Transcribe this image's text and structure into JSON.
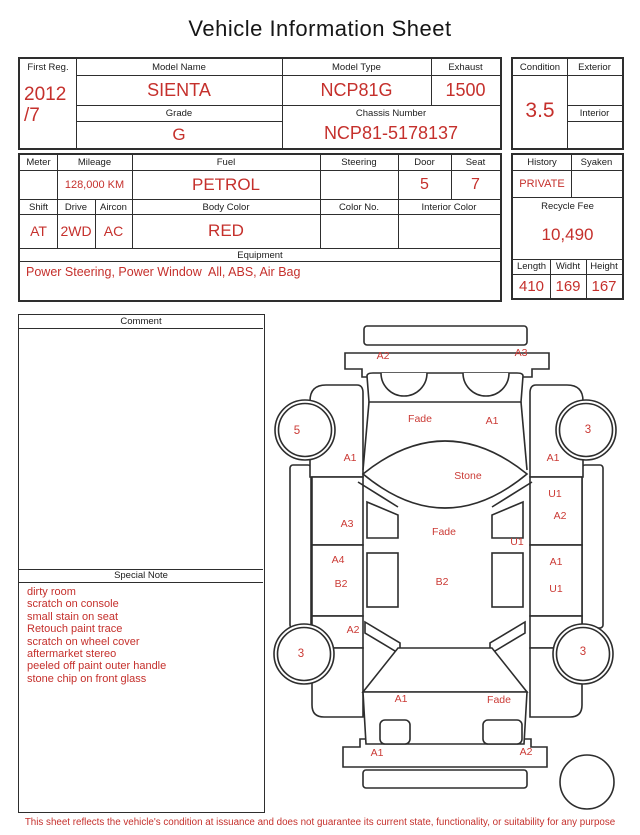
{
  "title": "Vehicle Information Sheet",
  "accent_color": "#c5302c",
  "table1": {
    "first_reg_label": "First Reg.",
    "first_reg_line1": "2012",
    "first_reg_line2": "/7",
    "model_name_label": "Model Name",
    "model_name": "SIENTA",
    "model_type_label": "Model Type",
    "model_type": "NCP81G",
    "exhaust_label": "Exhaust",
    "exhaust": "1500",
    "grade_label": "Grade",
    "grade": "G",
    "chassis_label": "Chassis Number",
    "chassis": "NCP81-5178137",
    "condition_label": "Condition",
    "condition": "3.5",
    "exterior_label": "Exterior",
    "exterior": "",
    "interior_label": "Interior",
    "interior": ""
  },
  "table2": {
    "meter_label": "Meter",
    "meter": "",
    "mileage_label": "Mileage",
    "mileage": "128,000 KM",
    "fuel_label": "Fuel",
    "fuel": "PETROL",
    "steering_label": "Steering",
    "steering": "",
    "door_label": "Door",
    "door": "5",
    "seat_label": "Seat",
    "seat": "7",
    "shift_label": "Shift",
    "shift": "AT",
    "drive_label": "Drive",
    "drive": "2WD",
    "aircon_label": "Aircon",
    "aircon": "AC",
    "body_color_label": "Body Color",
    "body_color": "RED",
    "color_no_label": "Color No.",
    "color_no": "",
    "interior_color_label": "Interior Color",
    "interior_color": "",
    "equipment_label": "Equipment",
    "equipment": "Power Steering, Power Window  All, ABS, Air Bag",
    "history_label": "History",
    "history": "PRIVATE",
    "syaken_label": "Syaken",
    "syaken": "",
    "recycle_fee_label": "Recycle Fee",
    "recycle_fee": "10,490",
    "length_label": "Length",
    "length": "410",
    "width_label": "Widht",
    "width": "169",
    "height_label": "Height",
    "height": "167"
  },
  "comment": {
    "label": "Comment",
    "text": ""
  },
  "special_note": {
    "label": "Special Note",
    "lines": [
      "dirty room",
      "scratch on console",
      "small stain on seat",
      "Retouch paint trace",
      "scratch on wheel cover",
      "aftermarket stereo",
      "peeled off paint outer handle",
      "stone chip on front glass"
    ]
  },
  "diagram": {
    "damage_labels": [
      {
        "text": "A2",
        "x": 113,
        "y": 49
      },
      {
        "text": "A3",
        "x": 251,
        "y": 46
      },
      {
        "text": "Fade",
        "x": 150,
        "y": 112
      },
      {
        "text": "A1",
        "x": 222,
        "y": 114
      },
      {
        "text": "A1",
        "x": 80,
        "y": 151
      },
      {
        "text": "A1",
        "x": 283,
        "y": 151
      },
      {
        "text": "Stone",
        "x": 198,
        "y": 169
      },
      {
        "text": "U1",
        "x": 285,
        "y": 187
      },
      {
        "text": "A2",
        "x": 290,
        "y": 209
      },
      {
        "text": "A3",
        "x": 77,
        "y": 217
      },
      {
        "text": "Fade",
        "x": 174,
        "y": 225
      },
      {
        "text": "U1",
        "x": 247,
        "y": 235
      },
      {
        "text": "A4",
        "x": 68,
        "y": 253
      },
      {
        "text": "A1",
        "x": 286,
        "y": 255
      },
      {
        "text": "B2",
        "x": 71,
        "y": 277
      },
      {
        "text": "B2",
        "x": 172,
        "y": 275
      },
      {
        "text": "U1",
        "x": 286,
        "y": 282
      },
      {
        "text": "A2",
        "x": 83,
        "y": 323
      },
      {
        "text": "A1",
        "x": 131,
        "y": 392
      },
      {
        "text": "Fade",
        "x": 229,
        "y": 393
      },
      {
        "text": "A1",
        "x": 107,
        "y": 446
      },
      {
        "text": "A2",
        "x": 256,
        "y": 445
      }
    ],
    "wheel_labels": [
      {
        "text": "5",
        "x": 27,
        "y": 124
      },
      {
        "text": "3",
        "x": 318,
        "y": 123
      },
      {
        "text": "3",
        "x": 31,
        "y": 347
      },
      {
        "text": "3",
        "x": 313,
        "y": 345
      }
    ]
  },
  "footer": "This sheet reflects the vehicle's condition at issuance and does not guarantee its current state, functionality, or suitability for any purpose"
}
